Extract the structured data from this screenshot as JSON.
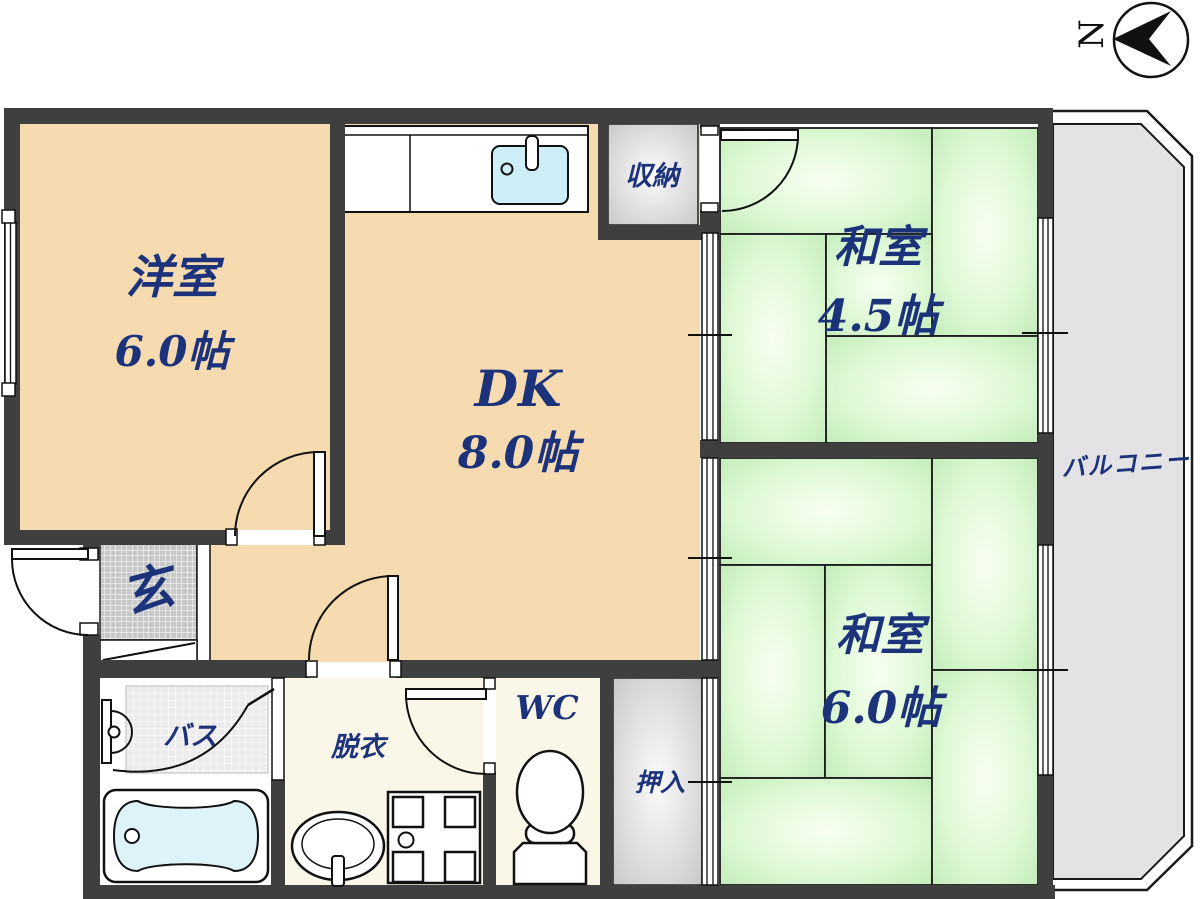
{
  "compass": {
    "north_label": "N"
  },
  "rooms": {
    "western_room": {
      "name": "洋室",
      "size": "6.0帖"
    },
    "dining_kitchen": {
      "name": "DK",
      "size": "8.0帖"
    },
    "japanese_room_45": {
      "name": "和室",
      "size": "4.5帖"
    },
    "japanese_room_60": {
      "name": "和室",
      "size": "6.0帖"
    },
    "storage": {
      "name": "収納"
    },
    "closet": {
      "name": "押入"
    },
    "entrance": {
      "name": "玄"
    },
    "bath": {
      "name": "バス"
    },
    "dressing_room": {
      "name": "脱衣"
    },
    "toilet": {
      "name": "WC"
    },
    "balcony": {
      "name": "バルコニー"
    }
  },
  "colors": {
    "wall": "#3f3f3f",
    "wood_floor": "#f6dbb0",
    "tatami_green": "#cdeec2",
    "closet_gray": "#d9d9d9",
    "balcony_gray": "#e3e3e5",
    "label_navy": "#1c337c",
    "sink_blue": "#cdeef7",
    "tub_blue": "#def2f9"
  }
}
